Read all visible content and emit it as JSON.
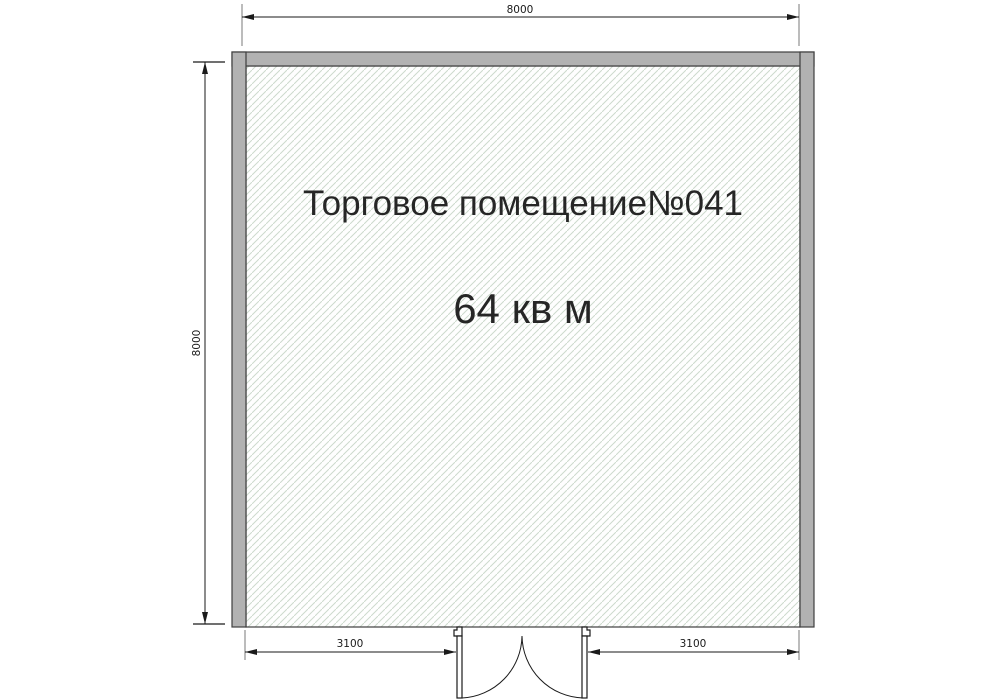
{
  "room": {
    "name": "Торговое помещение№041",
    "area": "64 кв м"
  },
  "dimensions": {
    "top_width": "8000",
    "left_height": "8000",
    "bottom_left_segment": "3100",
    "bottom_right_segment": "3100"
  },
  "colors": {
    "background": "#ffffff",
    "wall_fill": "#b2b2b2",
    "wall_outline": "#3f3f3f",
    "hatch_line": "#ccd9cc",
    "dimension_line": "#1a1a1a",
    "extension_line": "#8f8f8f",
    "text_color": "#262626"
  }
}
